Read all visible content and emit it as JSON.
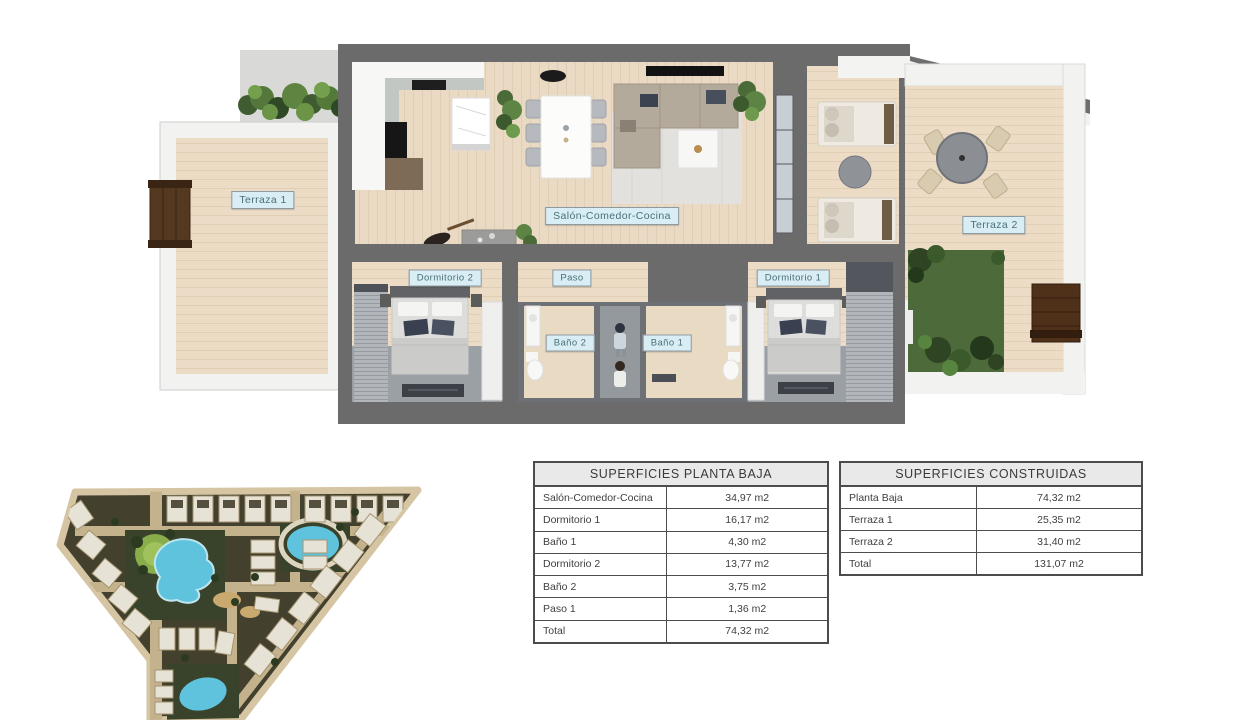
{
  "floor_plan": {
    "labels": [
      {
        "id": "terraza-1",
        "text": "Terraza 1"
      },
      {
        "id": "salon-comedor-cocina",
        "text": "Salón-Comedor-Cocina"
      },
      {
        "id": "dormitorio-2",
        "text": "Dormitorio 2"
      },
      {
        "id": "paso",
        "text": "Paso"
      },
      {
        "id": "dormitorio-1",
        "text": "Dormitorio 1"
      },
      {
        "id": "bano-2",
        "text": "Baño 2"
      },
      {
        "id": "bano-1",
        "text": "Baño 1"
      },
      {
        "id": "terraza-2",
        "text": "Terraza 2"
      }
    ],
    "label_colors": {
      "background": "#d9edf4",
      "text": "#4a7078",
      "border": "#8e9aa0"
    }
  },
  "tables": {
    "planta_baja": {
      "title": "SUPERFICIES PLANTA BAJA",
      "rows": [
        {
          "label": "Salón-Comedor-Cocina",
          "value": "34,97 m2"
        },
        {
          "label": "Dormitorio 1",
          "value": "16,17 m2"
        },
        {
          "label": "Baño 1",
          "value": "4,30 m2"
        },
        {
          "label": "Dormitorio 2",
          "value": "13,77 m2"
        },
        {
          "label": "Baño 2",
          "value": "3,75 m2"
        },
        {
          "label": "Paso 1",
          "value": "1,36 m2"
        },
        {
          "label": "Total",
          "value": "74,32 m2"
        }
      ]
    },
    "construidas": {
      "title": "SUPERFICIES CONSTRUIDAS",
      "rows": [
        {
          "label": "Planta Baja",
          "value": "74,32 m2"
        },
        {
          "label": "Terraza 1",
          "value": "25,35 m2"
        },
        {
          "label": "Terraza 2",
          "value": "31,40 m2"
        },
        {
          "label": "Total",
          "value": "131,07 m2"
        }
      ]
    }
  },
  "colors": {
    "wall": "#6b6b6b",
    "floor_wood": "#ecdcc6",
    "floor_gray": "#9aa0a4",
    "white_wall": "#f2f2f1",
    "table_border": "#4c4c4c",
    "table_header_bg": "#e9e9e9",
    "pool": "#5fc3dd",
    "lawn": "#88ad4a",
    "site_ground": "#43402e",
    "site_road": "#c4b28d",
    "garden_green": "#4d6b3a",
    "bench_brown": "#4f3119"
  }
}
